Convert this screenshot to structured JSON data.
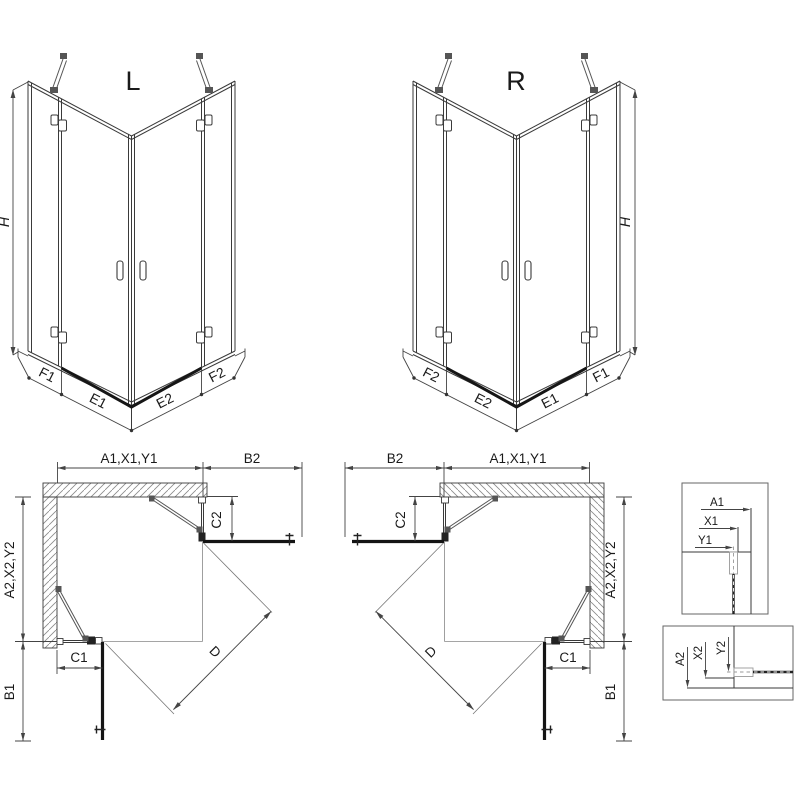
{
  "drawing_title": "corner shower enclosure technical drawing",
  "colors": {
    "line": "#3a3a3a",
    "door": "#141414",
    "dim": "#444444",
    "bar": "#555555",
    "hatch": "#777777",
    "background": "#ffffff"
  },
  "iso_left": {
    "label": "L",
    "height_dim": "H",
    "bottom_dims": [
      "F1",
      "E1",
      "E2",
      "F2"
    ]
  },
  "iso_right": {
    "label": "R",
    "height_dim": "H",
    "bottom_dims": [
      "F2",
      "E2",
      "E1",
      "F1"
    ]
  },
  "plan_left": {
    "top_width_dim": "A1,X1,Y1",
    "top_door_dim": "B2",
    "right_fixed_dim": "C2",
    "left_depth_dim": "A2,X2,Y2",
    "bottom_fixed_dim": "C1",
    "bottom_door_dim": "B1",
    "diagonal_dim": "D"
  },
  "plan_right": {
    "top_door_dim": "B2",
    "top_width_dim": "A1,X1,Y1",
    "left_fixed_dim": "C2",
    "right_depth_dim": "A2,X2,Y2",
    "bottom_fixed_dim": "C1",
    "bottom_door_dim": "B1",
    "diagonal_dim": "D"
  },
  "detail_top": {
    "dim_a": "A1",
    "dim_x": "X1",
    "dim_y": "Y1"
  },
  "detail_bottom": {
    "dim_a": "A2",
    "dim_x": "X2",
    "dim_y": "Y2"
  }
}
